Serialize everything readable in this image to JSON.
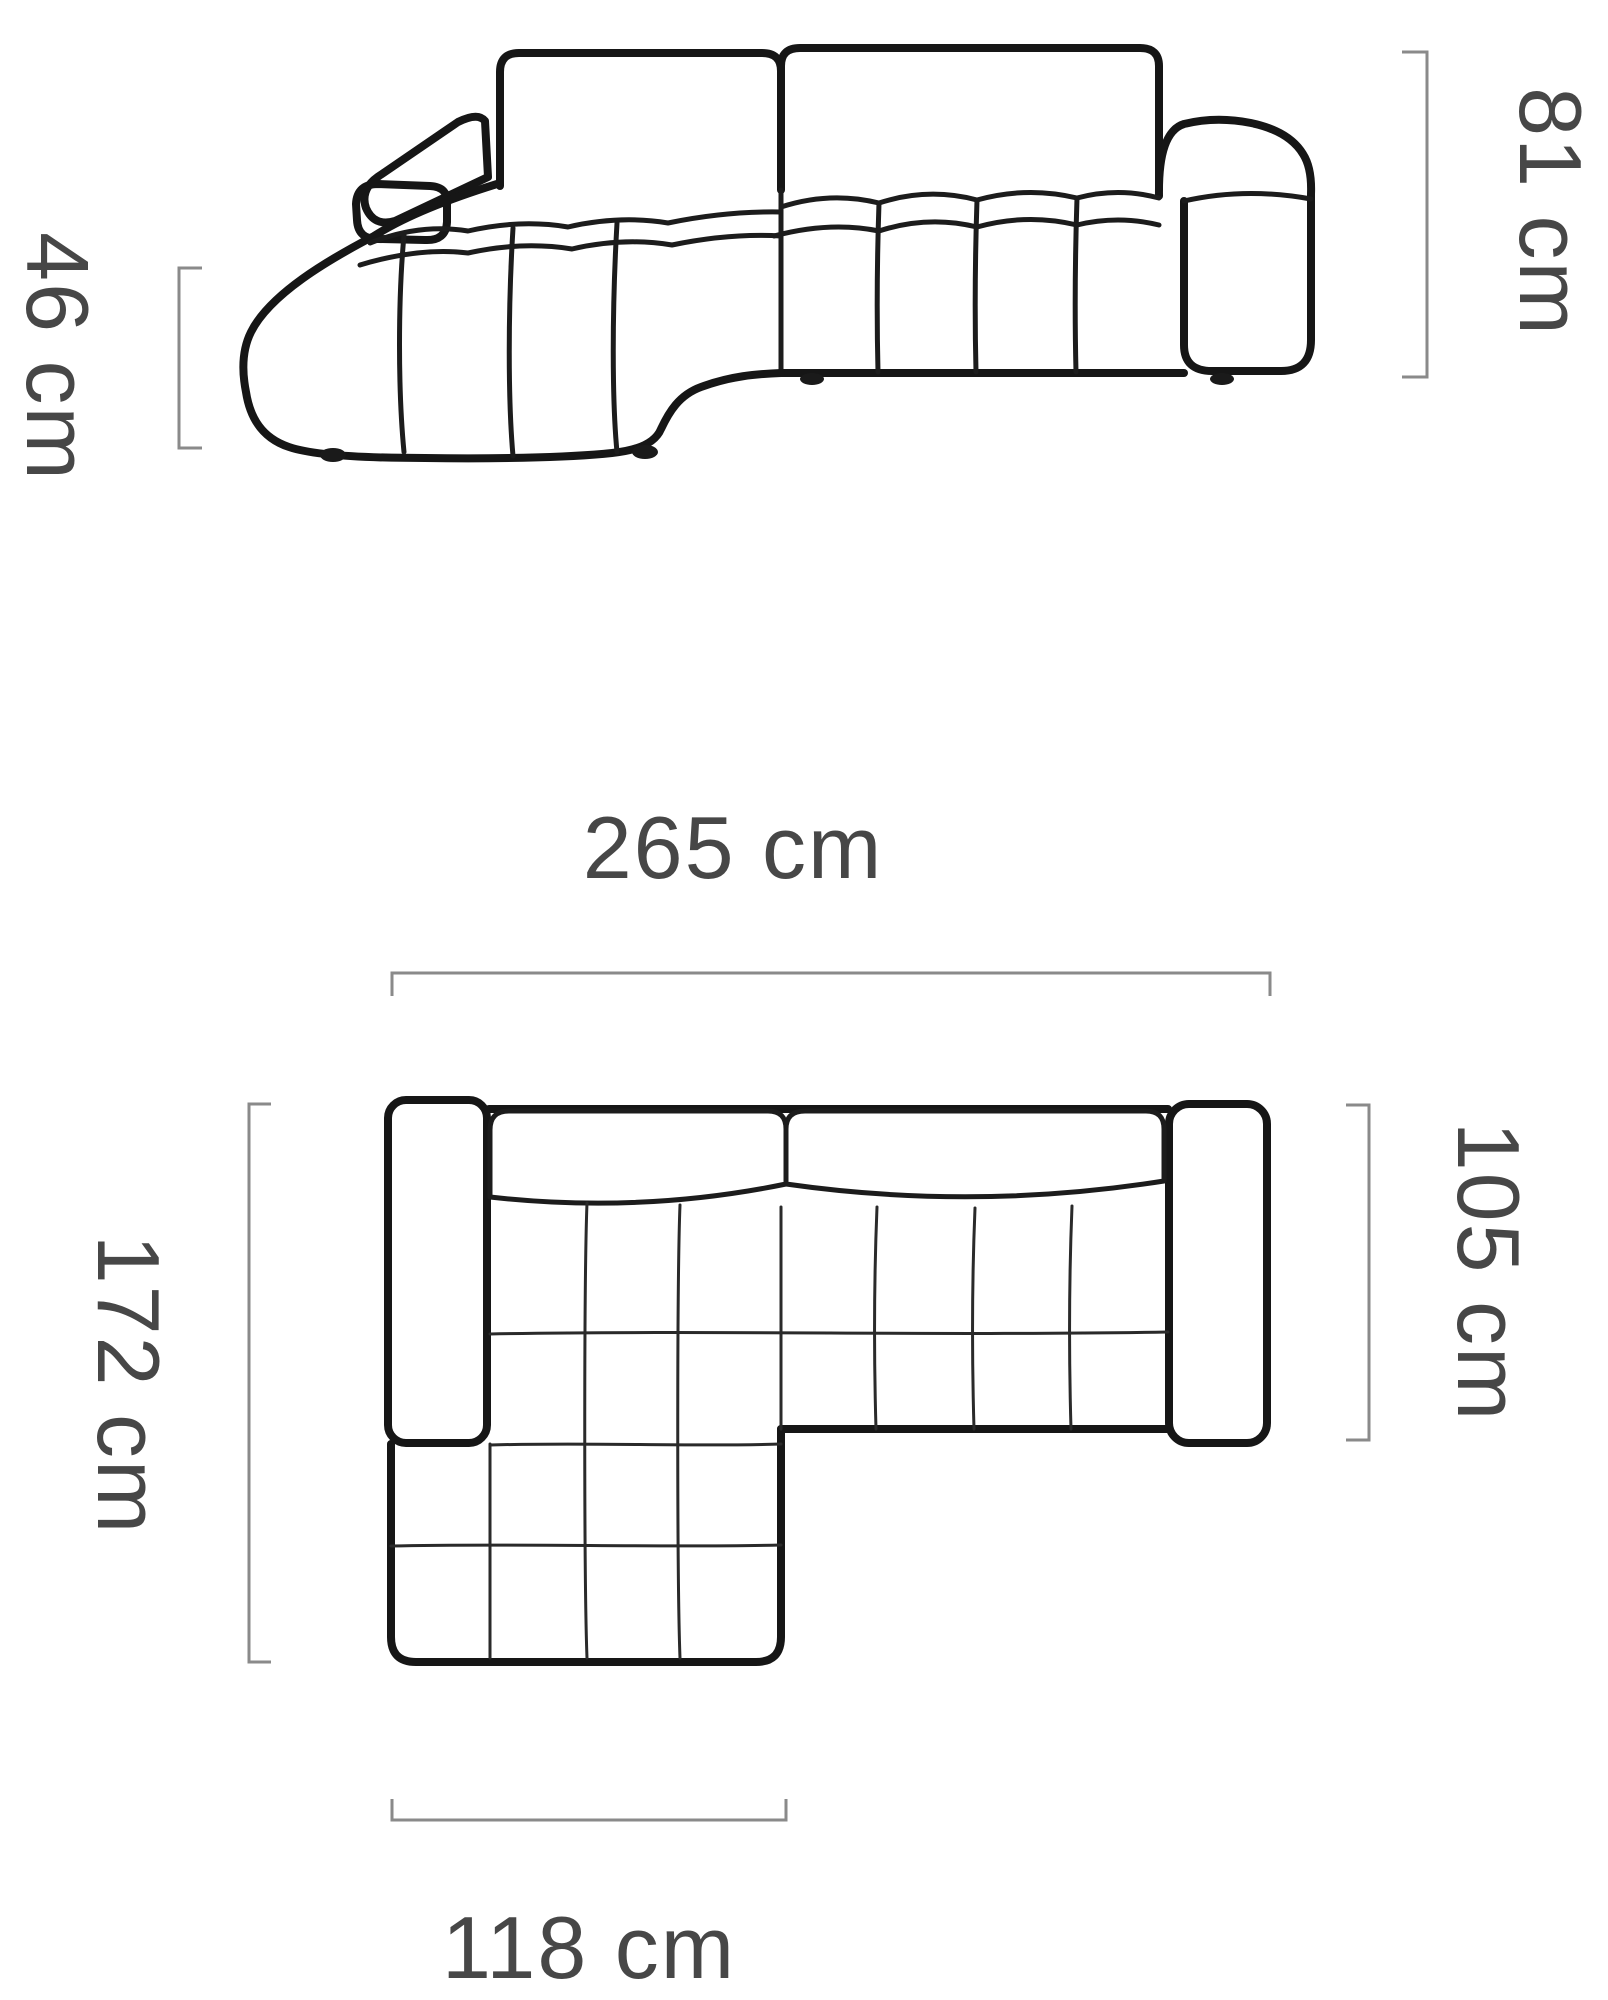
{
  "diagram": {
    "subject": "corner-sofa-with-chaise",
    "views": {
      "front": "front-elevation-view",
      "top": "top-plan-view"
    },
    "colors": {
      "background": "#ffffff",
      "sofa_outline": "#161616",
      "dimension_line": "#8a8a8a",
      "dimension_text": "#474747"
    },
    "dimensions": {
      "total_height": {
        "label": "81 cm"
      },
      "seat_height": {
        "label": "46 cm"
      },
      "total_width": {
        "label": "265 cm"
      },
      "total_depth": {
        "label": "172 cm"
      },
      "body_depth": {
        "label": "105 cm"
      },
      "chaise_width": {
        "label": "118 cm"
      }
    }
  }
}
